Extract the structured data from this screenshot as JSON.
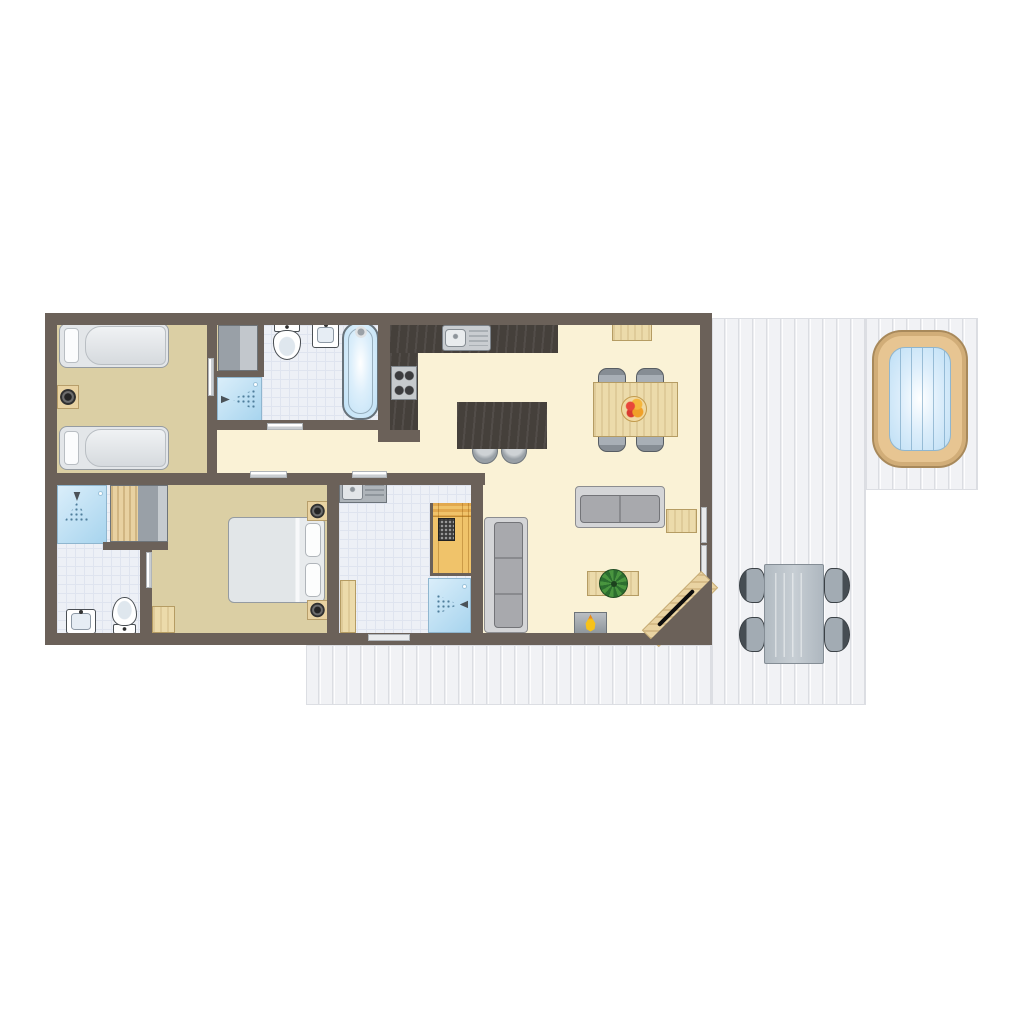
{
  "meta": {
    "title": "Holiday home floor plan (top view)",
    "canvas": {
      "width": 1024,
      "height": 1024,
      "background": "#ffffff"
    }
  },
  "palette": {
    "wall": "#6b6159",
    "floor_cream": "#faf2d6",
    "floor_tan": "#dbcfa4",
    "tile": "#edf0f6",
    "water_blue": "#bedff5",
    "shower_blue": "#a7d4ee",
    "wood_light": "#ecdbab",
    "sauna_wood": "#f0c36a",
    "hot_tub_wood": "#e7c592",
    "deck": "#f2f3f6",
    "counter_dark": "#45403b",
    "furniture_gray": "#a8a9ad",
    "door_marker": "#c9cdd1",
    "flame_yellow": "#f6c21b",
    "plant_green": "#49953f"
  },
  "elements": [
    {
      "name": "deck-right",
      "kind": "deck",
      "x": 712,
      "y": 318,
      "w": 154,
      "h": 387
    },
    {
      "name": "deck-hot-tub-extension",
      "kind": "deck",
      "x": 866,
      "y": 318,
      "w": 112,
      "h": 172
    },
    {
      "name": "deck-bottom",
      "kind": "deck",
      "x": 306,
      "y": 645,
      "w": 406,
      "h": 60
    },
    {
      "name": "hot-tub",
      "kind": "hot-tub",
      "x": 872,
      "y": 330,
      "w": 96,
      "h": 138
    },
    {
      "name": "outdoor-chair-top-left",
      "kind": "chair-out-l",
      "x": 739,
      "y": 568,
      "w": 26,
      "h": 35
    },
    {
      "name": "outdoor-chair-bottom-left",
      "kind": "chair-out-l",
      "x": 739,
      "y": 617,
      "w": 26,
      "h": 35
    },
    {
      "name": "outdoor-chair-top-right",
      "kind": "chair-out-r",
      "x": 824,
      "y": 568,
      "w": 26,
      "h": 35
    },
    {
      "name": "outdoor-chair-bottom-right",
      "kind": "chair-out-r",
      "x": 824,
      "y": 617,
      "w": 26,
      "h": 35
    },
    {
      "name": "outdoor-dining-table",
      "kind": "out-table",
      "x": 764,
      "y": 564,
      "w": 60,
      "h": 100
    },
    {
      "name": "building-floor",
      "kind": "base",
      "x": 51,
      "y": 319,
      "w": 655,
      "h": 320
    },
    {
      "name": "bedroom-1-floor",
      "kind": "floor-tan",
      "x": 57,
      "y": 325,
      "w": 150,
      "h": 148
    },
    {
      "name": "closet-floor",
      "kind": "floor-tan",
      "x": 213,
      "y": 325,
      "w": 45,
      "h": 46
    },
    {
      "name": "bathroom-1-floor",
      "kind": "floor-tile",
      "x": 262,
      "y": 325,
      "w": 116,
      "h": 95
    },
    {
      "name": "bedroom-2-floor",
      "kind": "floor-tan",
      "x": 152,
      "y": 485,
      "w": 175,
      "h": 148
    },
    {
      "name": "bathroom-2-floor",
      "kind": "floor-tile",
      "x": 57,
      "y": 485,
      "w": 83,
      "h": 148
    },
    {
      "name": "bathroom-3-floor",
      "kind": "floor-tile",
      "x": 339,
      "y": 485,
      "w": 132,
      "h": 148
    },
    {
      "name": "bedroom1-single-bed-top",
      "kind": "bed-single",
      "x": 59,
      "y": 323,
      "w": 110,
      "h": 45
    },
    {
      "name": "bedroom1-single-bed-bottom",
      "kind": "bed-single",
      "x": 59,
      "y": 426,
      "w": 110,
      "h": 44
    },
    {
      "name": "bedroom1-nightstand",
      "kind": "nightstand",
      "x": 57,
      "y": 385,
      "w": 22,
      "h": 24
    },
    {
      "name": "closet-wardrobe",
      "kind": "wardrobe-gray",
      "x": 218,
      "y": 325,
      "w": 40,
      "h": 46
    },
    {
      "name": "bathroom1-shower",
      "kind": "shower",
      "x": 217,
      "y": 377,
      "w": 45,
      "h": 45
    },
    {
      "name": "bathroom1-shower-spray-icon",
      "kind": "spray-r",
      "x": 221,
      "y": 389,
      "w": 34,
      "h": 21
    },
    {
      "name": "bathroom1-toilet",
      "kind": "toilet-down",
      "x": 271,
      "y": 322,
      "w": 32,
      "h": 38
    },
    {
      "name": "bathroom1-sink",
      "kind": "sink-white",
      "x": 312,
      "y": 322,
      "w": 27,
      "h": 26
    },
    {
      "name": "bathroom1-bathtub",
      "kind": "bathtub",
      "x": 342,
      "y": 322,
      "w": 37,
      "h": 98
    },
    {
      "name": "kitchen-counter-top",
      "kind": "counter-dark",
      "x": 390,
      "y": 322,
      "w": 168,
      "h": 31
    },
    {
      "name": "kitchen-counter-left",
      "kind": "counter-dark",
      "x": 390,
      "y": 353,
      "w": 28,
      "h": 77
    },
    {
      "name": "kitchen-stove",
      "kind": "stove",
      "x": 391,
      "y": 366,
      "w": 26,
      "h": 34
    },
    {
      "name": "kitchen-sink",
      "kind": "sink-steel",
      "x": 442,
      "y": 325,
      "w": 49,
      "h": 26
    },
    {
      "name": "island-stool-left",
      "kind": "stool",
      "x": 472,
      "y": 438,
      "w": 26,
      "h": 26
    },
    {
      "name": "island-stool-right",
      "kind": "stool",
      "x": 501,
      "y": 438,
      "w": 26,
      "h": 26
    },
    {
      "name": "kitchen-island",
      "kind": "counter-dark",
      "x": 457,
      "y": 402,
      "w": 90,
      "h": 47
    },
    {
      "name": "dining-chair-top-left",
      "kind": "chair-n",
      "x": 598,
      "y": 368,
      "w": 28,
      "h": 20
    },
    {
      "name": "dining-chair-top-right",
      "kind": "chair-n",
      "x": 636,
      "y": 368,
      "w": 28,
      "h": 20
    },
    {
      "name": "dining-chair-bottom-left",
      "kind": "chair-s",
      "x": 598,
      "y": 432,
      "w": 28,
      "h": 20
    },
    {
      "name": "dining-chair-bottom-right",
      "kind": "chair-s",
      "x": 636,
      "y": 432,
      "w": 28,
      "h": 20
    },
    {
      "name": "dining-table",
      "kind": "table-wood",
      "x": 593,
      "y": 382,
      "w": 85,
      "h": 55
    },
    {
      "name": "fruit-bowl",
      "kind": "fruit-bowl",
      "x": 621,
      "y": 396,
      "w": 26,
      "h": 26
    },
    {
      "name": "sideboard",
      "kind": "table-wood",
      "x": 612,
      "y": 322,
      "w": 40,
      "h": 19
    },
    {
      "name": "sofa-two-seat",
      "kind": "sofa-h",
      "x": 575,
      "y": 486,
      "w": 90,
      "h": 42
    },
    {
      "name": "side-table",
      "kind": "table-wood",
      "x": 666,
      "y": 509,
      "w": 31,
      "h": 24
    },
    {
      "name": "sofa-three-seat",
      "kind": "sofa-v",
      "x": 484,
      "y": 517,
      "w": 44,
      "h": 116
    },
    {
      "name": "coffee-table",
      "kind": "table-wood",
      "x": 587,
      "y": 571,
      "w": 52,
      "h": 25
    },
    {
      "name": "plant",
      "kind": "plant",
      "x": 599,
      "y": 569,
      "w": 29,
      "h": 29
    },
    {
      "name": "fireplace",
      "kind": "fireplace",
      "x": 574,
      "y": 612,
      "w": 33,
      "h": 22
    },
    {
      "name": "bathroom3-sink-counter",
      "kind": "counter-gray",
      "x": 339,
      "y": 479,
      "w": 48,
      "h": 24
    },
    {
      "name": "sauna",
      "kind": "sauna",
      "x": 430,
      "y": 503,
      "w": 41,
      "h": 73
    },
    {
      "name": "sauna-heater",
      "kind": "sauna-heater",
      "x": 438,
      "y": 518,
      "w": 17,
      "h": 23
    },
    {
      "name": "bathroom3-shower",
      "kind": "shower",
      "x": 428,
      "y": 578,
      "w": 43,
      "h": 55
    },
    {
      "name": "bathroom3-shower-spray-icon",
      "kind": "spray-l",
      "x": 436,
      "y": 594,
      "w": 32,
      "h": 21
    },
    {
      "name": "bathroom3-cabinet",
      "kind": "table-wood",
      "x": 340,
      "y": 580,
      "w": 16,
      "h": 53
    },
    {
      "name": "bathroom2-shower",
      "kind": "shower",
      "x": 57,
      "y": 485,
      "w": 50,
      "h": 59
    },
    {
      "name": "bathroom2-shower-spray-icon",
      "kind": "spray-d",
      "x": 64,
      "y": 492,
      "w": 26,
      "h": 30
    },
    {
      "name": "bedroom2-wardrobe",
      "kind": "wardrobe-mixed",
      "x": 110,
      "y": 485,
      "w": 58,
      "h": 57
    },
    {
      "name": "bathroom2-toilet",
      "kind": "toilet-up",
      "x": 111,
      "y": 597,
      "w": 27,
      "h": 37
    },
    {
      "name": "bathroom2-sink",
      "kind": "sink-white",
      "x": 66,
      "y": 609,
      "w": 30,
      "h": 25
    },
    {
      "name": "bedroom2-double-bed",
      "kind": "bed-double",
      "x": 228,
      "y": 517,
      "w": 97,
      "h": 86
    },
    {
      "name": "bedroom2-nightstand-top",
      "kind": "nightstand",
      "x": 307,
      "y": 501,
      "w": 21,
      "h": 20
    },
    {
      "name": "bedroom2-nightstand-bottom",
      "kind": "nightstand",
      "x": 307,
      "y": 600,
      "w": 21,
      "h": 20
    },
    {
      "name": "bedroom2-dresser",
      "kind": "table-wood",
      "x": 152,
      "y": 606,
      "w": 23,
      "h": 27
    },
    {
      "name": "wall-top",
      "kind": "wall",
      "x": 45,
      "y": 313,
      "w": 667,
      "h": 12
    },
    {
      "name": "wall-bottom",
      "kind": "wall",
      "x": 45,
      "y": 633,
      "w": 667,
      "h": 12
    },
    {
      "name": "wall-left",
      "kind": "wall",
      "x": 45,
      "y": 313,
      "w": 12,
      "h": 332
    },
    {
      "name": "wall-right",
      "kind": "wall",
      "x": 700,
      "y": 313,
      "w": 12,
      "h": 332
    },
    {
      "name": "wall-bedroom1-right",
      "kind": "wall",
      "x": 207,
      "y": 325,
      "w": 10,
      "h": 148
    },
    {
      "name": "wall-closet-right",
      "kind": "wall",
      "x": 258,
      "y": 325,
      "w": 6,
      "h": 50
    },
    {
      "name": "wall-closet-bottom",
      "kind": "wall",
      "x": 217,
      "y": 371,
      "w": 47,
      "h": 6
    },
    {
      "name": "wall-bathroom1-kitchen",
      "kind": "wall",
      "x": 378,
      "y": 313,
      "w": 12,
      "h": 117
    },
    {
      "name": "wall-bathroom1-bottom",
      "kind": "wall",
      "x": 217,
      "y": 420,
      "w": 173,
      "h": 10
    },
    {
      "name": "wall-kitchen-stub",
      "kind": "wall",
      "x": 378,
      "y": 430,
      "w": 42,
      "h": 12
    },
    {
      "name": "wall-middle-horizontal",
      "kind": "wall",
      "x": 45,
      "y": 473,
      "w": 440,
      "h": 12
    },
    {
      "name": "wall-bathroom2-right",
      "kind": "wall",
      "x": 140,
      "y": 550,
      "w": 12,
      "h": 83
    },
    {
      "name": "wall-under-wardrobe2",
      "kind": "wall",
      "x": 103,
      "y": 542,
      "w": 65,
      "h": 8
    },
    {
      "name": "wall-bedroom2-right",
      "kind": "wall",
      "x": 327,
      "y": 485,
      "w": 12,
      "h": 148
    },
    {
      "name": "wall-bathroom3-right",
      "kind": "wall",
      "x": 471,
      "y": 485,
      "w": 12,
      "h": 148
    },
    {
      "name": "door-bedroom1",
      "kind": "doorbar-v",
      "x": 208,
      "y": 358,
      "w": 6,
      "h": 38
    },
    {
      "name": "door-bathroom1",
      "kind": "doorbar-h",
      "x": 267,
      "y": 423,
      "w": 36,
      "h": 7
    },
    {
      "name": "door-bedroom2",
      "kind": "doorbar-h",
      "x": 250,
      "y": 471,
      "w": 37,
      "h": 7
    },
    {
      "name": "door-bathroom3",
      "kind": "doorbar-h",
      "x": 352,
      "y": 471,
      "w": 35,
      "h": 7
    },
    {
      "name": "door-bathroom2",
      "kind": "doorbar-v",
      "x": 146,
      "y": 552,
      "w": 6,
      "h": 36
    },
    {
      "name": "window-right-upper",
      "kind": "windowbar",
      "x": 701,
      "y": 507,
      "w": 6,
      "h": 36
    },
    {
      "name": "window-right-lower",
      "kind": "windowbar",
      "x": 701,
      "y": 545,
      "w": 6,
      "h": 34
    },
    {
      "name": "window-bottom",
      "kind": "windowbar",
      "x": 368,
      "y": 634,
      "w": 42,
      "h": 7
    },
    {
      "name": "entrance-floor",
      "kind": "ent-wood",
      "x": 638,
      "y": 597,
      "w": 84,
      "h": 24,
      "rot": -45
    },
    {
      "name": "entrance-corner-wall",
      "kind": "ent-tri",
      "x": 645,
      "y": 578,
      "w": 67,
      "h": 67
    },
    {
      "name": "entrance-door",
      "kind": "ent-door",
      "x": 651,
      "y": 606,
      "w": 50,
      "h": 4,
      "rot": -45
    }
  ]
}
